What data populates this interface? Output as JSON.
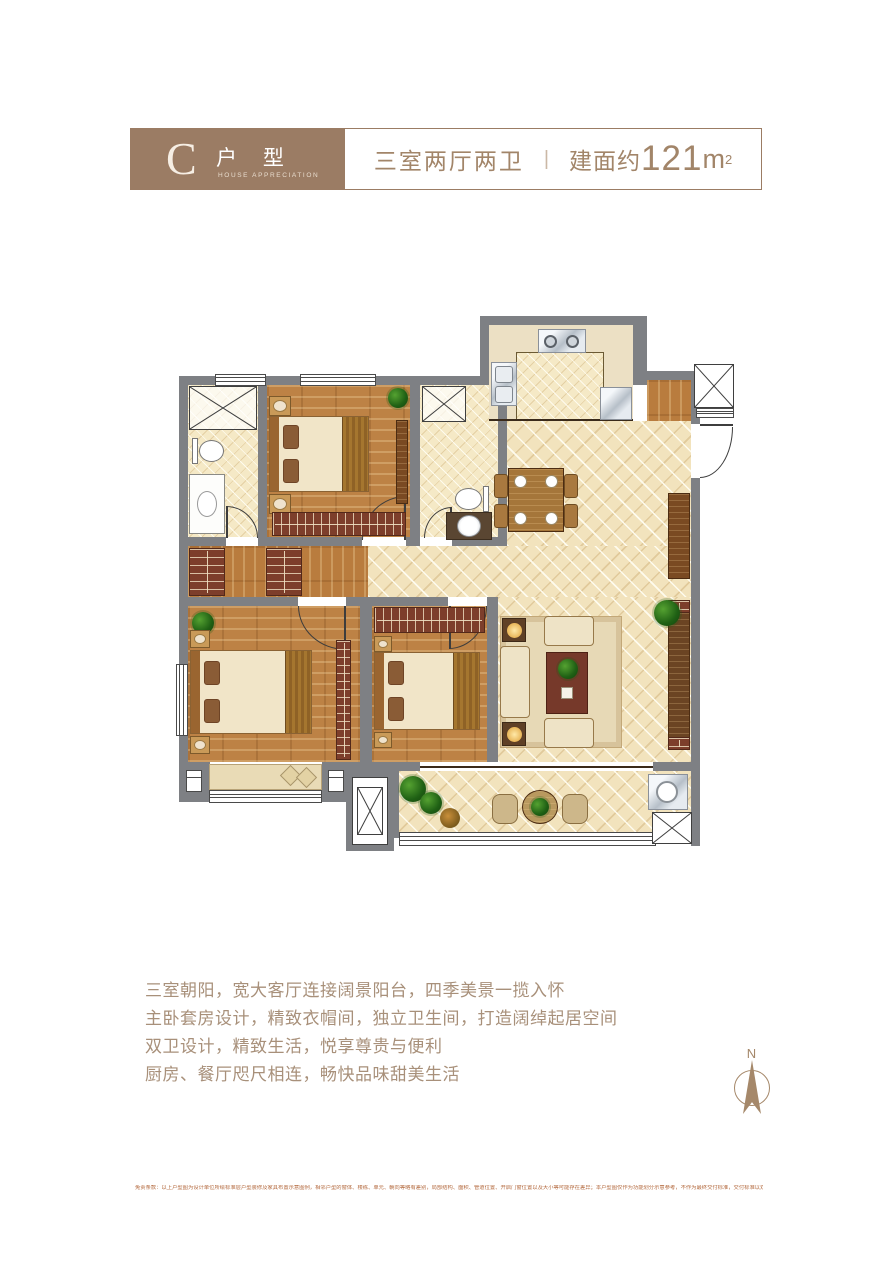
{
  "header": {
    "type_letter": "C",
    "type_label": "户 型",
    "type_sub": "HOUSE APPRECIATION",
    "layout": "三室两厅两卫",
    "divider": "|",
    "area_prefix": "建面约",
    "area_num": "121",
    "area_unit": "m",
    "area_sup": "2"
  },
  "description": {
    "lines": [
      "三室朝阳，宽大客厅连接阔景阳台，四季美景一揽入怀",
      "主卧套房设计，精致衣帽间，独立卫生间，打造阔绰起居空间",
      "双卫设计，精致生活，悦享尊贵与便利",
      "厨房、餐厅咫尺相连，畅快品味甜美生活"
    ]
  },
  "compass": {
    "label": "N"
  },
  "disclaimer": "免责条款：以上户型图为设计单位所绘标准层户型装修及家具布置示意图例，相邻户型的窗体、楼栋、单元、朝向等略有差别，局部结构、面积、管道位置、开启门窗位置以及大小等可能存在差异；本户型图仅作为功能划分示意参考，不作为最终交付标准，交付标准以双方签订的商品房买卖合同及其附件约定为准。",
  "colors": {
    "brand_brown": "#9b7c64",
    "text_brown": "#a8907a",
    "wall_gray": "#7e8084",
    "tile_floor": "#f2e3bd",
    "wood_floor": "#bd8245",
    "furniture_red": "#7d3e2b",
    "disclaimer_text": "#b46a3f"
  },
  "floor_plan": {
    "rooms": [
      "master-bathroom",
      "master-bedroom",
      "second-bathroom",
      "kitchen",
      "entry",
      "walk-in-closet",
      "living-dining-room",
      "bedroom-2",
      "bedroom-3",
      "balcony",
      "bay-window",
      "stair-shaft",
      "ac-platform"
    ]
  }
}
